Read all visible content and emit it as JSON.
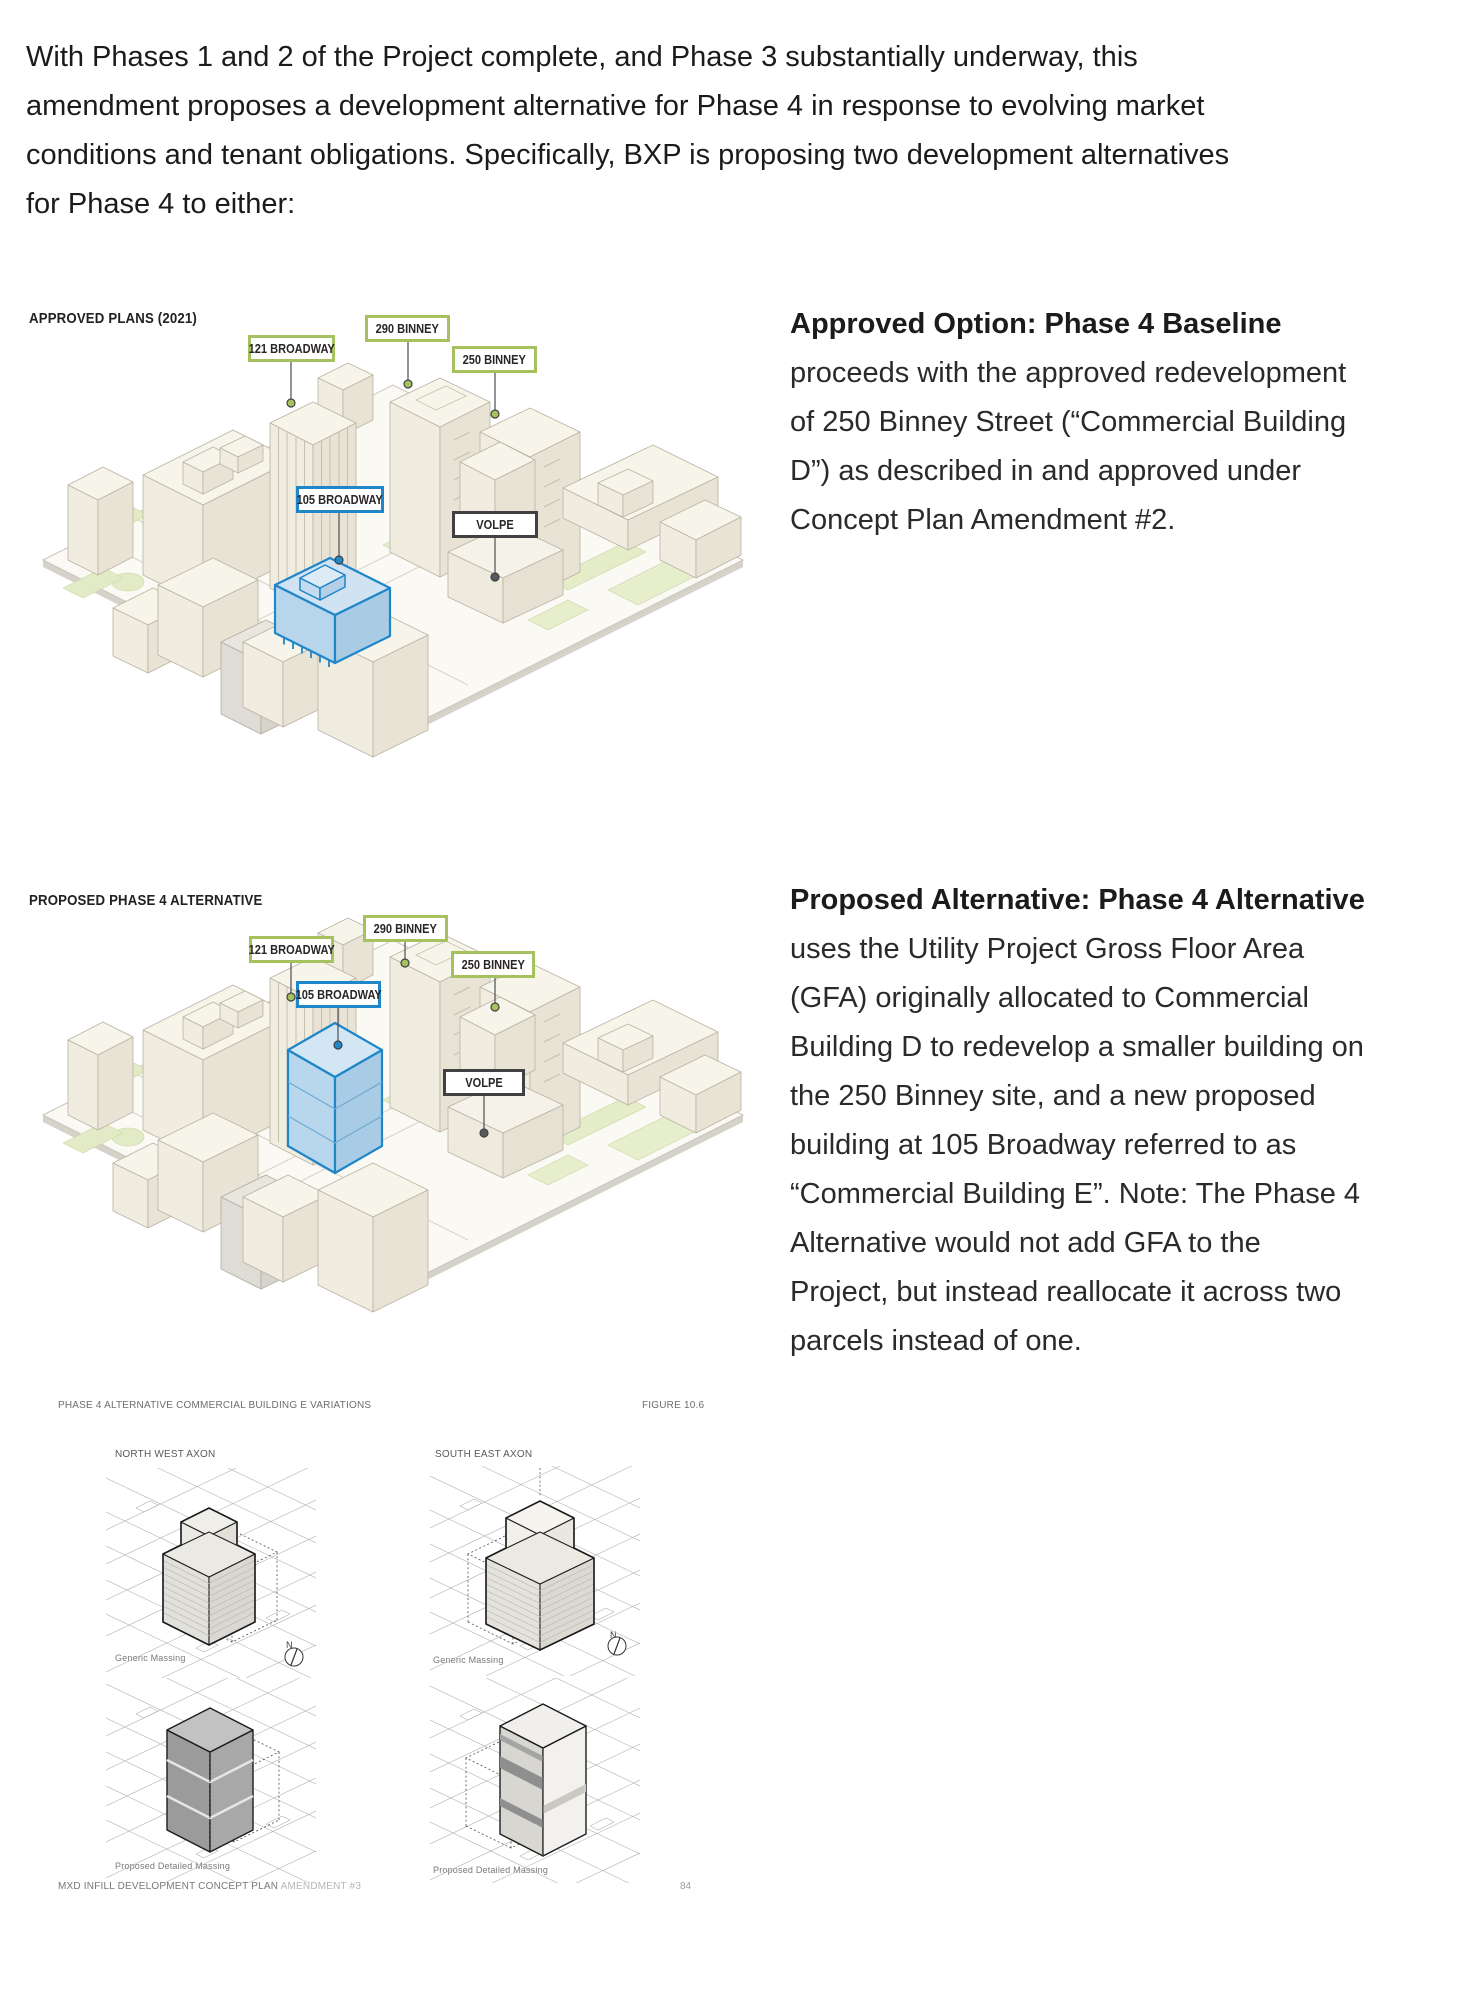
{
  "intro": "With Phases 1 and 2 of the Project complete, and Phase 3 substantially underway, this\namendment proposes a development alternative for Phase 4 in response to evolving market\nconditions and tenant obligations. Specifically, BXP is proposing two development alternatives\nfor Phase 4 to either:",
  "approved_section": {
    "title": "APPROVED PLANS (2021)",
    "description_heading": "Approved Option: Phase 4 Baseline",
    "description_body": "proceeds with the approved redevelopment\nof 250 Binney Street (“Commercial Building\nD”) as described in and approved under\nConcept Plan Amendment #2."
  },
  "proposed_section": {
    "title": "PROPOSED PHASE 4 ALTERNATIVE",
    "description_heading": "Proposed Alternative: Phase 4 Alternative",
    "description_body": "uses the Utility Project Gross Floor Area\n(GFA) originally allocated to Commercial\nBuilding D to redevelop a smaller building on\nthe 250 Binney site, and a new proposed\nbuilding at 105 Broadway referred to as\n“Commercial Building E”. Note: The Phase 4\nAlternative would not add GFA to the\nProject, but instead reallocate it across two\nparcels instead of one."
  },
  "site_labels": {
    "broadway_121": "121 BROADWAY",
    "binney_290": "290 BINNEY",
    "binney_250": "250 BINNEY",
    "broadway_105": "105 BROADWAY",
    "volpe": "VOLPE"
  },
  "figure_section": {
    "title": "PHASE 4 ALTERNATIVE COMMERCIAL BUILDING E VARIATIONS",
    "figure_number": "FIGURE 10.6",
    "northwest_label": "NORTH WEST AXON",
    "southeast_label": "SOUTH EAST AXON",
    "generic_caption": "Generic Massing",
    "detailed_caption": "Proposed Detailed Massing",
    "north_indicator": "N"
  },
  "footer": {
    "document_title": "MXD INFILL DEVELOPMENT CONCEPT PLAN ",
    "amendment": "AMENDMENT #3",
    "page_number": "84"
  },
  "colors": {
    "label_green": "#a6c25e",
    "label_blue": "#1f86c9",
    "label_dark": "#414042",
    "building_blue_fill": "#b9d7ec"
  }
}
